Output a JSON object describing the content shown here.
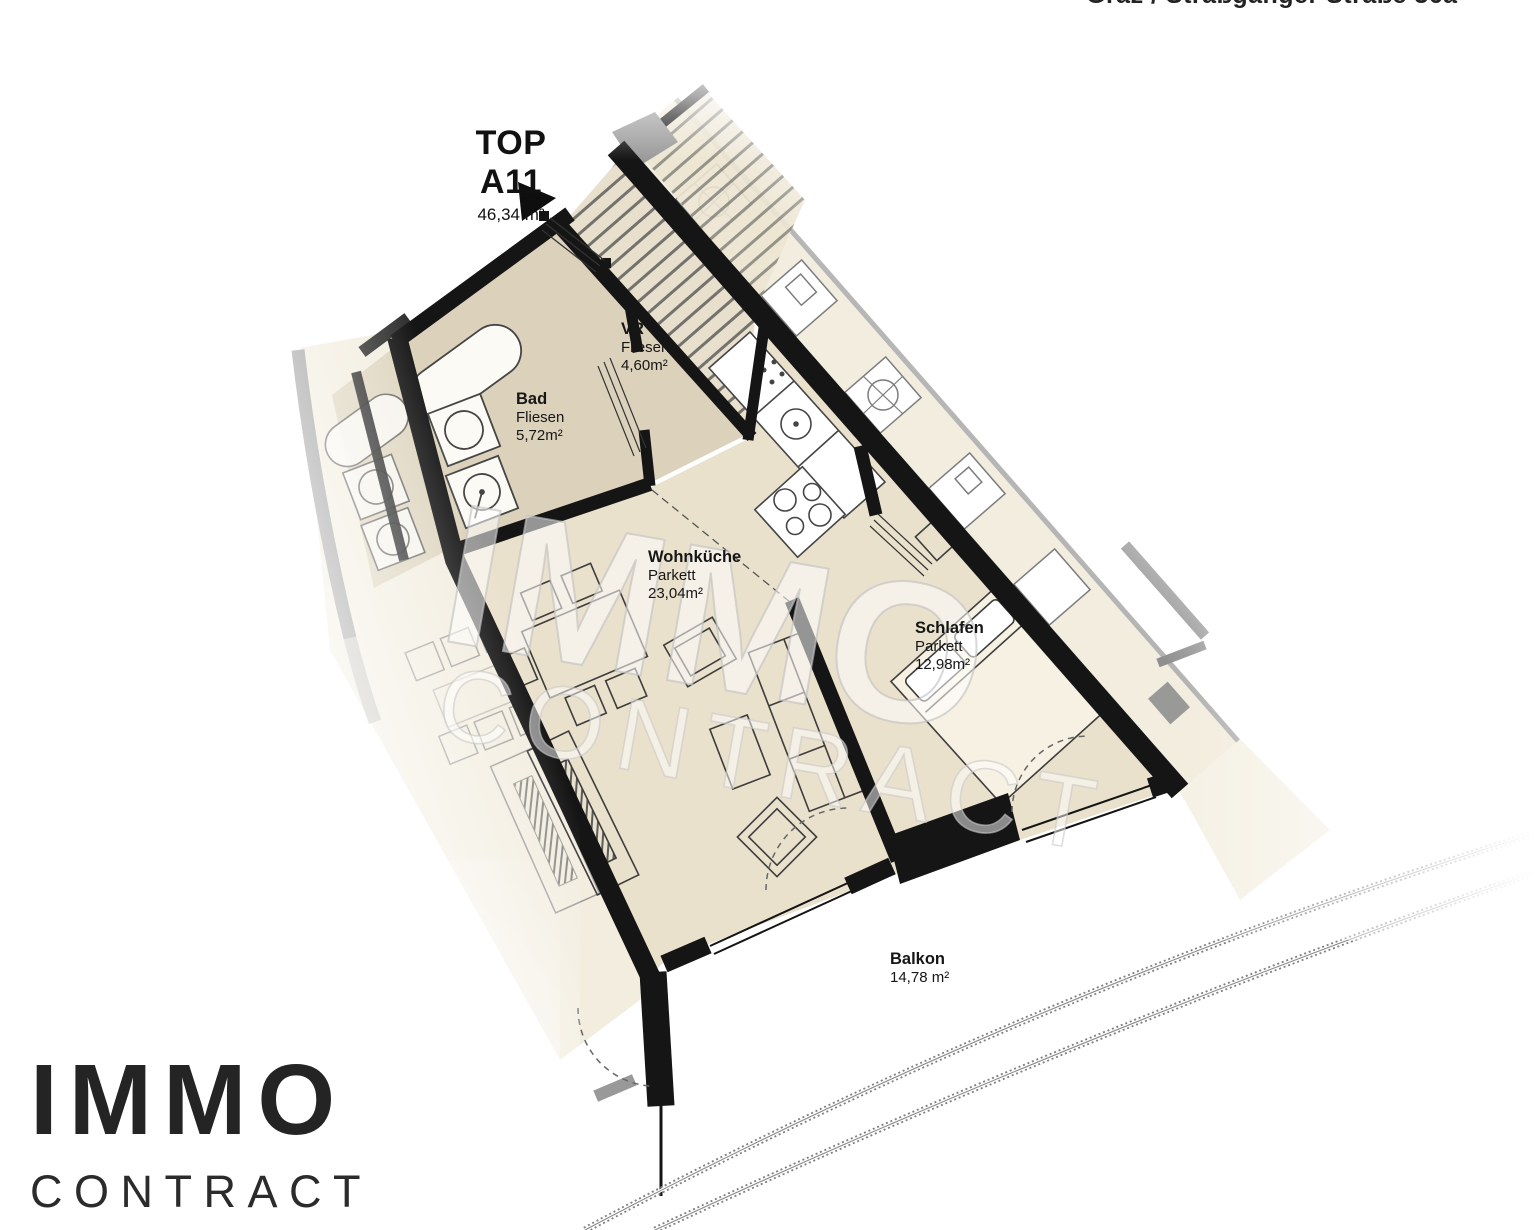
{
  "banner": {
    "address": "Graz / Straßganger Straße 36a"
  },
  "unit": {
    "name": "TOP A11",
    "area": "46,34 m²"
  },
  "rooms": {
    "bad": {
      "name": "Bad",
      "floor": "Fliesen",
      "area": "5,72m²"
    },
    "vr": {
      "name": "VR",
      "floor": "Fliesen",
      "area": "4,60m²"
    },
    "wohnkueche": {
      "name": "Wohnküche",
      "floor": "Parkett",
      "area": "23,04m²"
    },
    "schlafen": {
      "name": "Schlafen",
      "floor": "Parkett",
      "area": "12,98m²"
    },
    "balkon": {
      "name": "Balkon",
      "area": "14,78 m²"
    }
  },
  "watermark": {
    "line1": "IMMO",
    "line2": "CONTRACT"
  },
  "logo": {
    "brand": "IMMO",
    "sub": "CONTRACT"
  },
  "colors": {
    "wall": "#151515",
    "room_tile": "#dcd2bb",
    "room_parquet": "#eae1cd",
    "neighbor_area": "#f2ecdd",
    "neighbor_gray": "#9a9a9a",
    "fixture_fill": "#fcfaf5"
  }
}
